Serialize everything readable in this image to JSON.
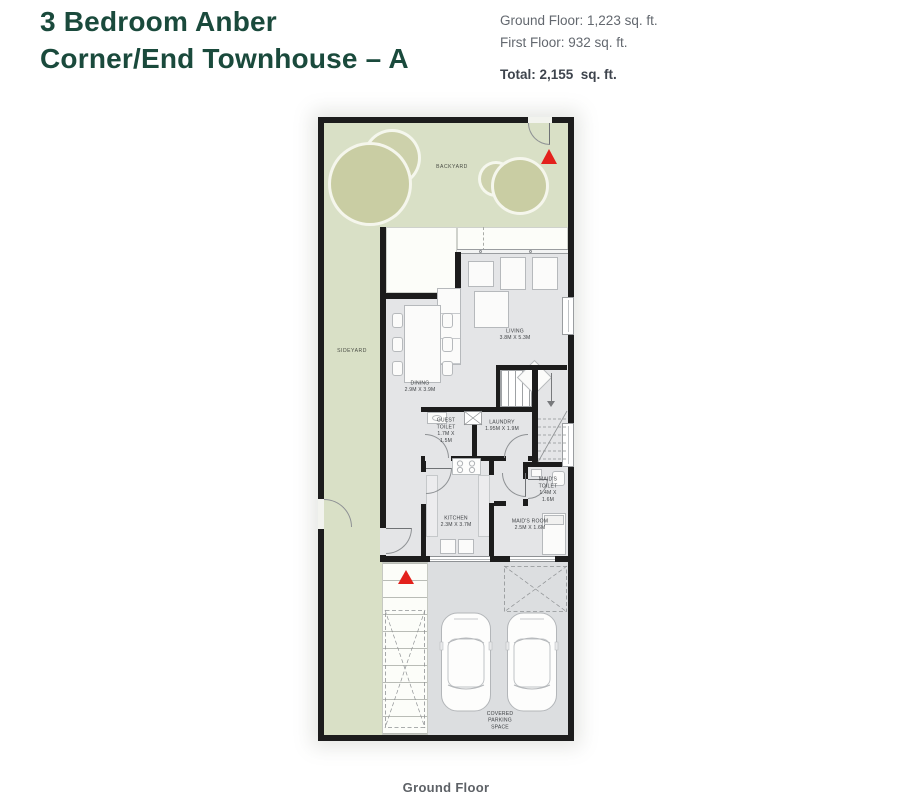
{
  "header": {
    "title_line1": "3 Bedroom Anber",
    "title_line2": "Corner/End Townhouse – A",
    "stats": {
      "ground_floor": "Ground Floor: 1,223 sq. ft.",
      "first_floor": "First Floor: 932 sq. ft.",
      "total": "Total: 2,155  sq. ft."
    }
  },
  "plan": {
    "areas": {
      "backyard": "BACKYARD",
      "sideyard": "SIDEYARD",
      "covered_parking": "COVERED PARKING SPACE"
    },
    "rooms": {
      "living": {
        "name": "LIVING",
        "dims": "3.8M X 5.3M"
      },
      "dining": {
        "name": "DINING",
        "dims": "2.9M X 3.9M"
      },
      "guest_toilet": {
        "name": "GUEST TOILET",
        "dims": "1.7M X 1.5M"
      },
      "laundry": {
        "name": "LAUNDRY",
        "dims": "1.95M X 1.9M"
      },
      "kitchen": {
        "name": "KITCHEN",
        "dims": "2.3M X 3.7M"
      },
      "maids_toilet": {
        "name": "MAID'S TOILET",
        "dims": "1.4M X 1.6M"
      },
      "maids_room": {
        "name": "MAID'S ROOM",
        "dims": "2.5M X 1.6M"
      }
    }
  },
  "caption": "Ground Floor",
  "colors": {
    "title_green": "#1a4a3c",
    "yard_green": "#d9e0c6",
    "tree_green": "#c9cda3",
    "interior_gray": "#e4e5e7",
    "parking_gray": "#dcdee0",
    "wall_black": "#1c1c1c",
    "arrow_red": "#e3211c",
    "stats_gray": "#63686f"
  }
}
